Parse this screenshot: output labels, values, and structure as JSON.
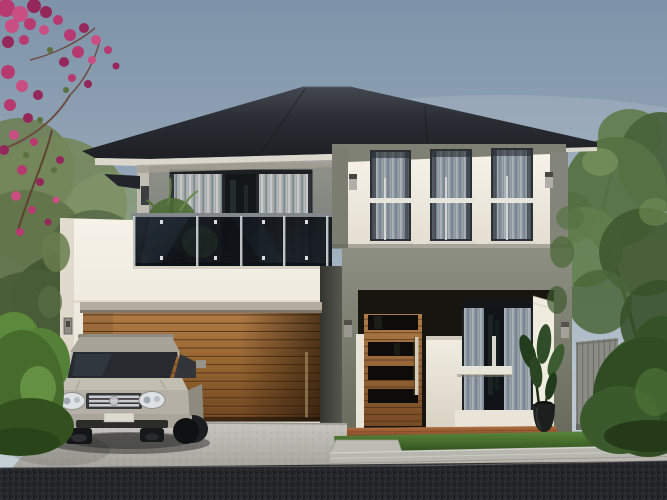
{
  "meta": {
    "kind": "architectural-3d-rendering",
    "description": "Street-view render of a modern two-storey house with charcoal hip roof, white render walls, timber garage door, glass balcony and a silver SUV parked on the driveway",
    "visible_text": "none"
  },
  "palette": {
    "sky_top": "#7e93a9",
    "sky_horizon": "#c9d2d8",
    "roof": "#24262b",
    "fascia": "#dcd7cd",
    "wall_white": "#f2eee5",
    "wall_olive": "#84867a",
    "frieze_gray": "#7e8073",
    "garage_timber": "#95612f",
    "entry_door_timber": "#8a5630",
    "glass_dark": "#15181d",
    "curtain_gray": "#9aa3ab",
    "balcony_glass": "#10141a",
    "railing_posts": "#ccd2d3",
    "driveway_concrete": "#b5b4ae",
    "asphalt_road": "#26272b",
    "lawn_green": "#4a7a2e",
    "hedge_green": "#32501f",
    "tree_foliage": "#5a7544",
    "bougainvillea_pink": "#b63a70",
    "car_silver": "#b5b0a5",
    "terracotta_step": "#8f5630",
    "fence_gray": "#8b8c85"
  },
  "scene": {
    "sky": {
      "label": "clear hazy sky"
    },
    "house": {
      "storeys": 2,
      "roof": {
        "label": "charcoal hip roof with wide eaves"
      },
      "balcony": {
        "label": "first-floor balcony with tinted glass balustrade",
        "glass_panels": 4,
        "posts": 5,
        "sliding_door": "curtained glass sliding door",
        "planter": "green shrub in dark planter box"
      },
      "upper_right_windows": {
        "count": 3,
        "style": "tall curtained windows with white mullion cross"
      },
      "wall_sconces": {
        "count": 4
      },
      "garage": {
        "door": "horizontal timber slat panel door",
        "slats": 13
      },
      "entry": {
        "door": "timber pivot door with 4 dark glass slats and long vertical pull handle",
        "ground_window": "curtained window with white ledge",
        "potted_plant": "dark urn with strappy plant",
        "step": "terracotta paved step"
      }
    },
    "vehicle": {
      "label": "silver luxury SUV parked facing viewer",
      "position": "in front of garage"
    },
    "landscaping": {
      "left": [
        "pink bougainvillea tree",
        "olive garden tree",
        "clipped green hedge"
      ],
      "right": [
        "leafy street tree",
        "grey timber fence",
        "tall hedge"
      ],
      "ground": [
        "concrete driveway",
        "stepping slab path",
        "lawn strip",
        "concrete footpath",
        "dark asphalt road"
      ]
    }
  }
}
